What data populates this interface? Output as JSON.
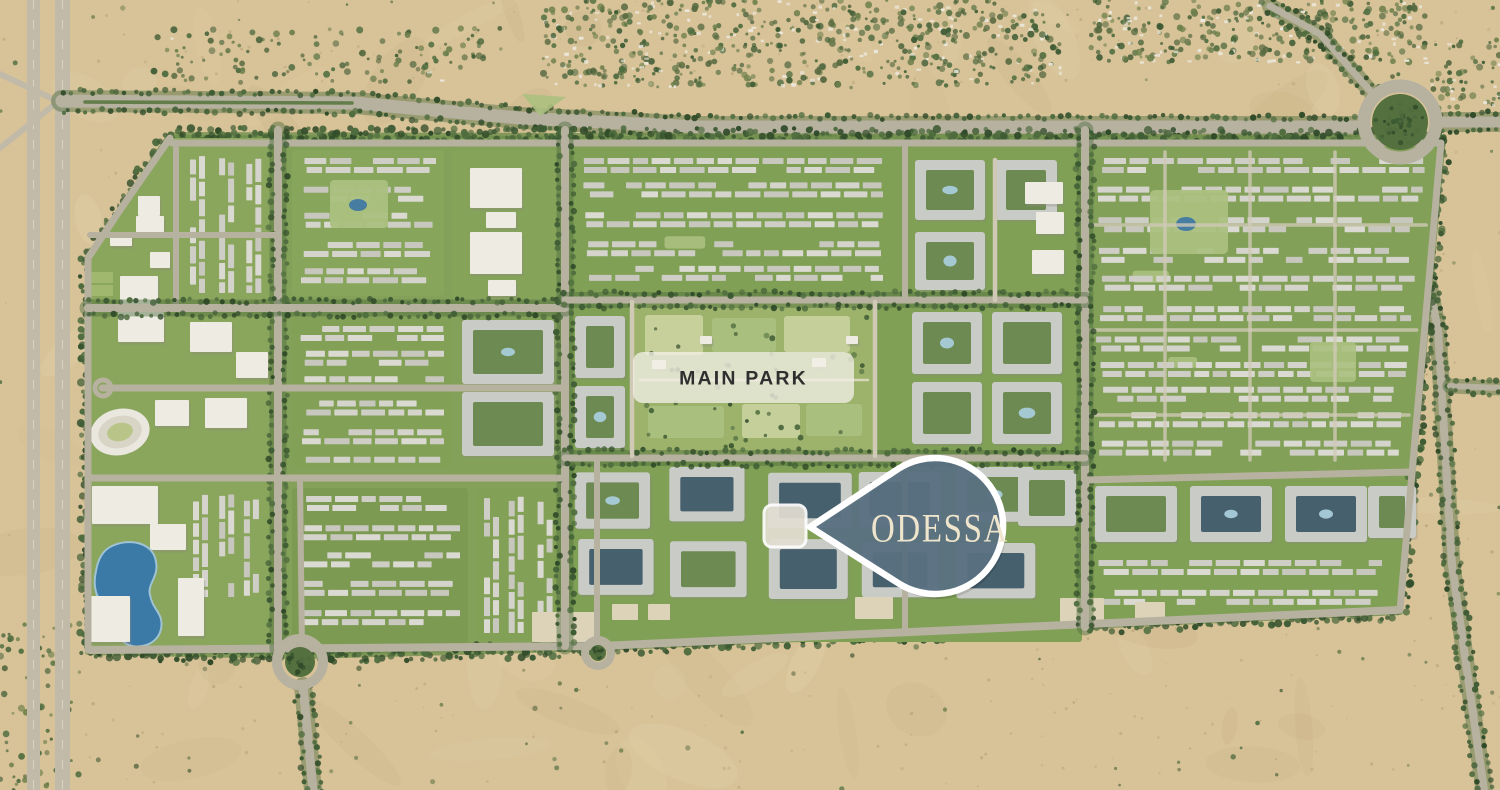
{
  "map": {
    "main_park_label": "MAIN PARK",
    "pin_label": "ODESSA"
  },
  "theme": {
    "sand": "#d8c399",
    "sand_dark": "#c2a87b",
    "sand_light": "#e8d8af",
    "pebble": "#b49b70",
    "dev_green": "#84a159",
    "lawn": "#abc07f",
    "lawn_pale": "#c9d29e",
    "tree_dark": "#3c5a33",
    "tree_mid": "#4e6c3e",
    "tree_deep": "#2f4a28",
    "road": "#b7b1a0",
    "road_light": "#cfc9b6",
    "road_dash": "#e9e3d1",
    "building": "#d5d4cc",
    "building_dark": "#c7c7be",
    "white_building": "#edebe2",
    "apt_gray": "#c9cbc6",
    "court_green": "#6d8a52",
    "court_dark": "#46606e",
    "pool": "#4179a2",
    "pool_light": "#a9ccda",
    "lake": "#3b79a6",
    "lake_rim": "#9fc3d4",
    "warehouse": "#ddd3b8",
    "pin_fill": "#5a7182",
    "pin_stroke": "#ffffff",
    "pin_text": "#efe4cc",
    "band_fill": "#f2efe5",
    "band_text": "#2f2f2f"
  }
}
